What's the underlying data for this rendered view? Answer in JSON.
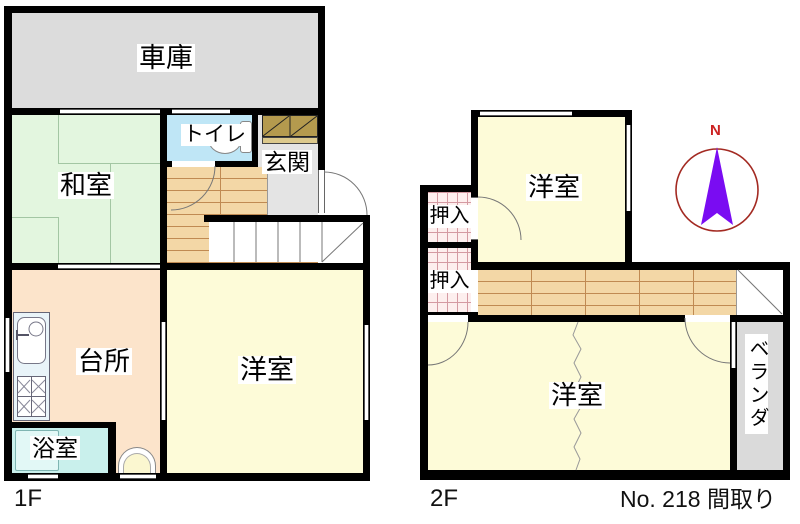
{
  "floor_plan": {
    "plan_number": "No. 218 間取り",
    "floor1": {
      "label": "1F",
      "rooms": {
        "garage": "車庫",
        "japanese_room": "和室",
        "toilet": "トイレ",
        "entrance": "玄関",
        "kitchen": "台所",
        "western_room": "洋室",
        "bathroom": "浴室"
      }
    },
    "floor2": {
      "label": "2F",
      "rooms": {
        "western_room_upper": "洋室",
        "closet_upper": "押入",
        "closet_lower": "押入",
        "western_room_lower": "洋室",
        "veranda": "ベランダ"
      }
    },
    "compass": {
      "north_label": "N"
    },
    "colors": {
      "wall": "#000000",
      "garage_fill": "#dcdcdc",
      "tatami_fill": "#e3f6df",
      "toilet_fill": "#bfe6f6",
      "entrance_floor": "#e4e4e4",
      "shoe_cabinet": "#b49a4e",
      "wood_floor": "#f3d7a6",
      "kitchen_fill": "#fce4cb",
      "western_room_fill": "#fdfbd8",
      "bath_fill": "#c9f0ec",
      "closet_hatch": "#fdefee",
      "veranda_fill": "#dadada",
      "compass_circle": "#a32a22",
      "compass_needle": "#7a0cf2",
      "north_text": "#cc2222"
    }
  }
}
